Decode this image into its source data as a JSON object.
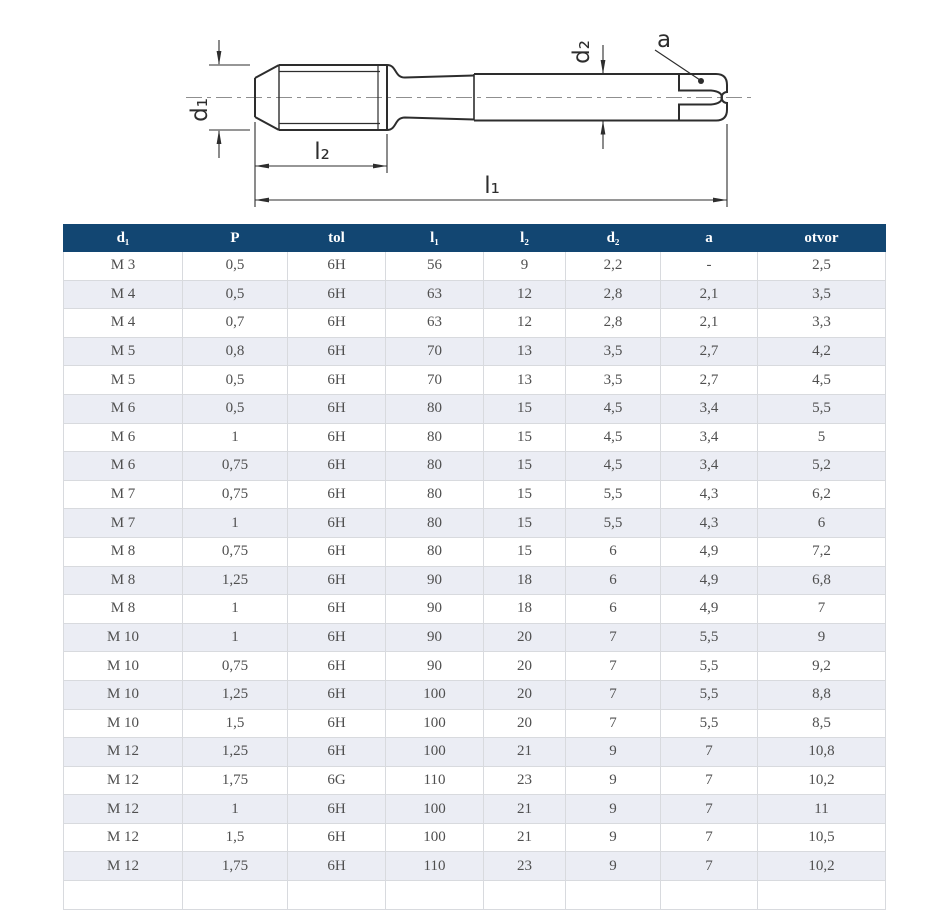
{
  "theme": {
    "header_bg": "#124672",
    "header_text": "#ffffff",
    "alt_row_bg": "#ebedf4",
    "row_bg": "#ffffff",
    "border_color": "#d8dade",
    "cell_text": "#4f4f4f",
    "line_color": "#2d2d2d",
    "centerline_color": "#8f8f8f"
  },
  "drawing": {
    "labels": {
      "d1": "d₁",
      "d2": "d₂",
      "l1": "l₁",
      "l2": "l₂",
      "a": "a"
    }
  },
  "table": {
    "columns": [
      "d₁",
      "P",
      "tol",
      "l₁",
      "l₂",
      "d₂",
      "a",
      "otvor"
    ],
    "rows": [
      [
        "M 3",
        "0,5",
        "6H",
        "56",
        "9",
        "2,2",
        "-",
        "2,5"
      ],
      [
        "M 4",
        "0,5",
        "6H",
        "63",
        "12",
        "2,8",
        "2,1",
        "3,5"
      ],
      [
        "M 4",
        "0,7",
        "6H",
        "63",
        "12",
        "2,8",
        "2,1",
        "3,3"
      ],
      [
        "M 5",
        "0,8",
        "6H",
        "70",
        "13",
        "3,5",
        "2,7",
        "4,2"
      ],
      [
        "M 5",
        "0,5",
        "6H",
        "70",
        "13",
        "3,5",
        "2,7",
        "4,5"
      ],
      [
        "M 6",
        "0,5",
        "6H",
        "80",
        "15",
        "4,5",
        "3,4",
        "5,5"
      ],
      [
        "M 6",
        "1",
        "6H",
        "80",
        "15",
        "4,5",
        "3,4",
        "5"
      ],
      [
        "M 6",
        "0,75",
        "6H",
        "80",
        "15",
        "4,5",
        "3,4",
        "5,2"
      ],
      [
        "M 7",
        "0,75",
        "6H",
        "80",
        "15",
        "5,5",
        "4,3",
        "6,2"
      ],
      [
        "M 7",
        "1",
        "6H",
        "80",
        "15",
        "5,5",
        "4,3",
        "6"
      ],
      [
        "M 8",
        "0,75",
        "6H",
        "80",
        "15",
        "6",
        "4,9",
        "7,2"
      ],
      [
        "M 8",
        "1,25",
        "6H",
        "90",
        "18",
        "6",
        "4,9",
        "6,8"
      ],
      [
        "M 8",
        "1",
        "6H",
        "90",
        "18",
        "6",
        "4,9",
        "7"
      ],
      [
        "M 10",
        "1",
        "6H",
        "90",
        "20",
        "7",
        "5,5",
        "9"
      ],
      [
        "M 10",
        "0,75",
        "6H",
        "90",
        "20",
        "7",
        "5,5",
        "9,2"
      ],
      [
        "M 10",
        "1,25",
        "6H",
        "100",
        "20",
        "7",
        "5,5",
        "8,8"
      ],
      [
        "M 10",
        "1,5",
        "6H",
        "100",
        "20",
        "7",
        "5,5",
        "8,5"
      ],
      [
        "M 12",
        "1,25",
        "6H",
        "100",
        "21",
        "9",
        "7",
        "10,8"
      ],
      [
        "M 12",
        "1,75",
        "6G",
        "110",
        "23",
        "9",
        "7",
        "10,2"
      ],
      [
        "M 12",
        "1",
        "6H",
        "100",
        "21",
        "9",
        "7",
        "11"
      ],
      [
        "M 12",
        "1,5",
        "6H",
        "100",
        "21",
        "9",
        "7",
        "10,5"
      ],
      [
        "M 12",
        "1,75",
        "6H",
        "110",
        "23",
        "9",
        "7",
        "10,2"
      ]
    ]
  }
}
